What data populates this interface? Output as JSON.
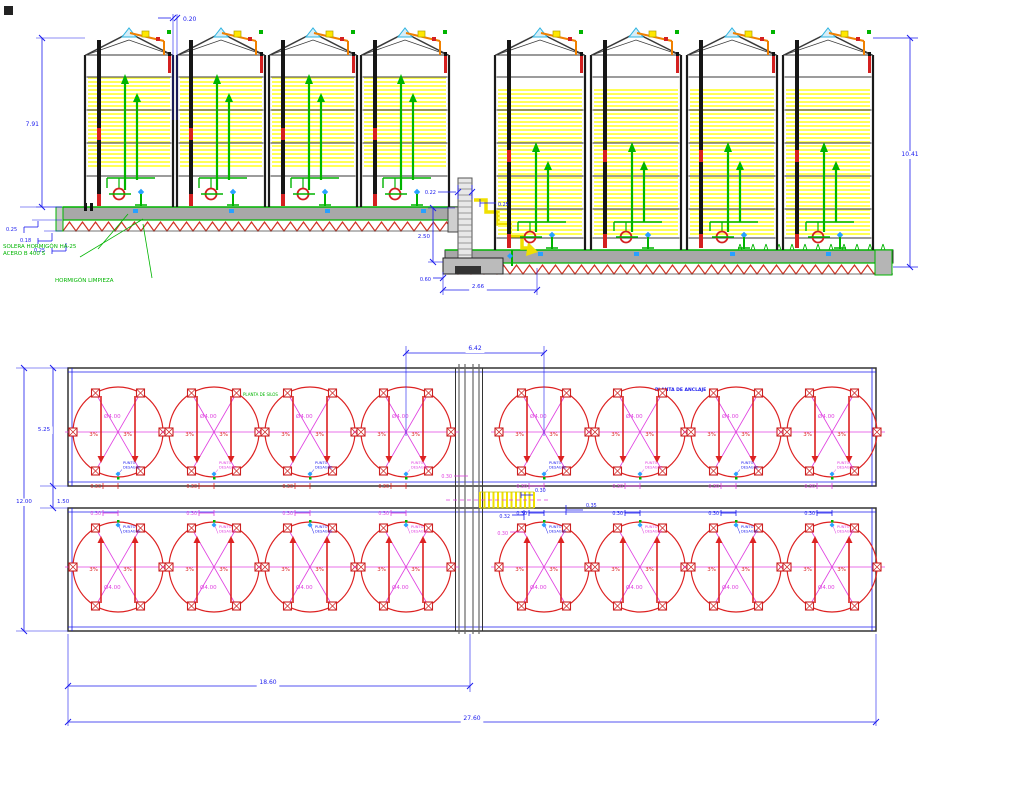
{
  "title": "Silos - alzado y planta de cimentación",
  "elevation": {
    "silos_left": 4,
    "silos_right": 4,
    "dim_gap_top": "0.20",
    "dim_height_left": "7.91",
    "dim_height_right": "10.41",
    "dim_slab_1": "0.25",
    "dim_slab_2": "0.18",
    "dim_slab_3": "0.25",
    "dim_wall_top": "0.22",
    "dim_wall_edge": "0.25",
    "dim_wall_height": "2.50",
    "dim_toe": "0.60",
    "dim_footing": "2.66",
    "label_solera_1": "SOLERA HORMIGÓN HA-25",
    "label_solera_2": "ACERO B 400 S",
    "label_limpieza": "HORMIGÓN LIMPIEZA"
  },
  "plan": {
    "rows": 2,
    "circles_per_row": 8,
    "label_left": "PLANTA DE SILOS",
    "label_right": "PLANTA DE ANCLAJE",
    "dim_span": "6.42",
    "dim_strip": "5.25",
    "dim_gap": "1.50",
    "dim_total_h": "12.00",
    "dim_left_w": "18.60",
    "dim_total_w": "27.60",
    "dim_d1": "0.30",
    "dim_d2": "0.32",
    "dim_d3": "0.35",
    "circle_diameter": "Ø4.00",
    "slope": "3%",
    "circle_offset": "0.30",
    "tiny_label_1": "PUNTO",
    "tiny_label_2": "DESAGÜE"
  },
  "colors": {
    "dim_blue": "#1a1aee",
    "red": "#d42020",
    "magenta": "#e040e0",
    "green": "#00b400",
    "band_yellow": "#ffff55",
    "arrow_yellow": "#f0e000",
    "orange": "#f08000",
    "cyan": "#28a0ff",
    "apex_cyan": "#30b4e0",
    "slab_gray": "#a8a8a8",
    "dark": "#222222",
    "hatch_red": "#d03020",
    "wall_gray": "#777777"
  }
}
